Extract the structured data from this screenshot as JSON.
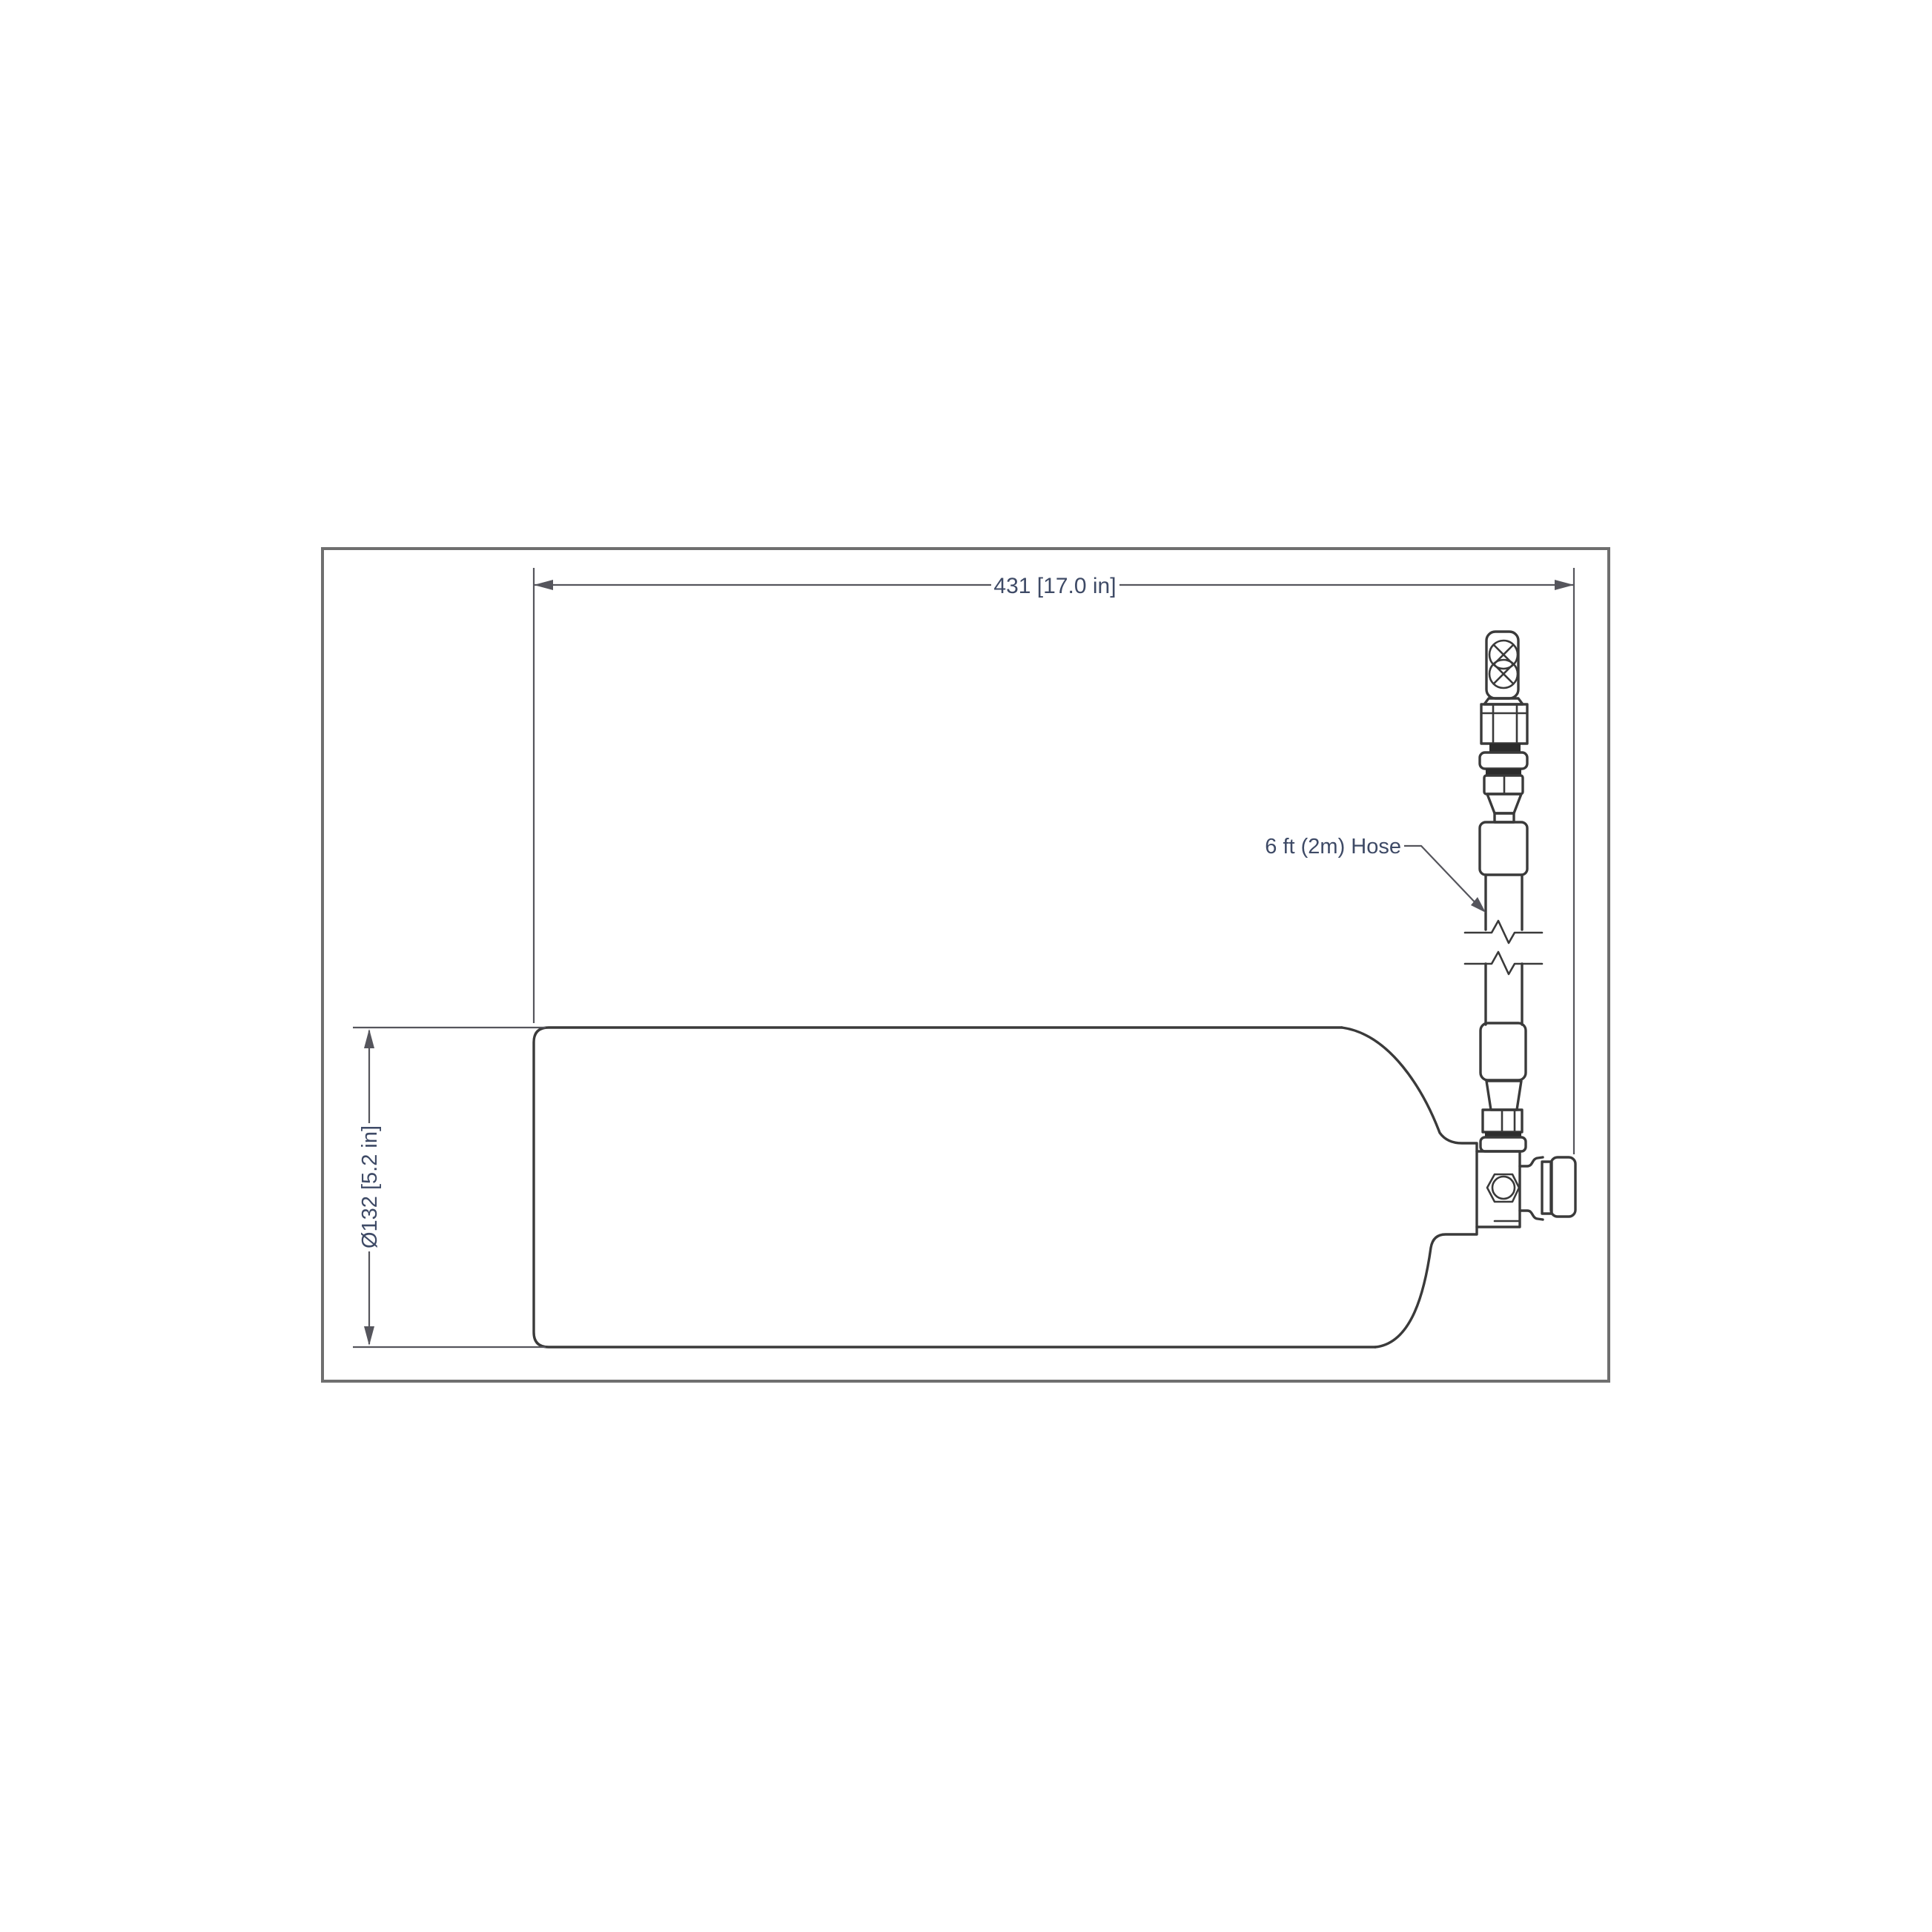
{
  "diagram": {
    "length_dimension": {
      "label": "431 [17.0 in]"
    },
    "diameter_dimension": {
      "label": "Ø132 [5.2 in]"
    },
    "hose_callout": {
      "label": "6 ft (2m) Hose"
    }
  },
  "colors": {
    "background": "#ffffff",
    "frame_line": "#6f6f6f",
    "drawing_line": "#3a3a3a",
    "dimension_line": "#55555c",
    "annotation_text": "#3e4a66"
  }
}
